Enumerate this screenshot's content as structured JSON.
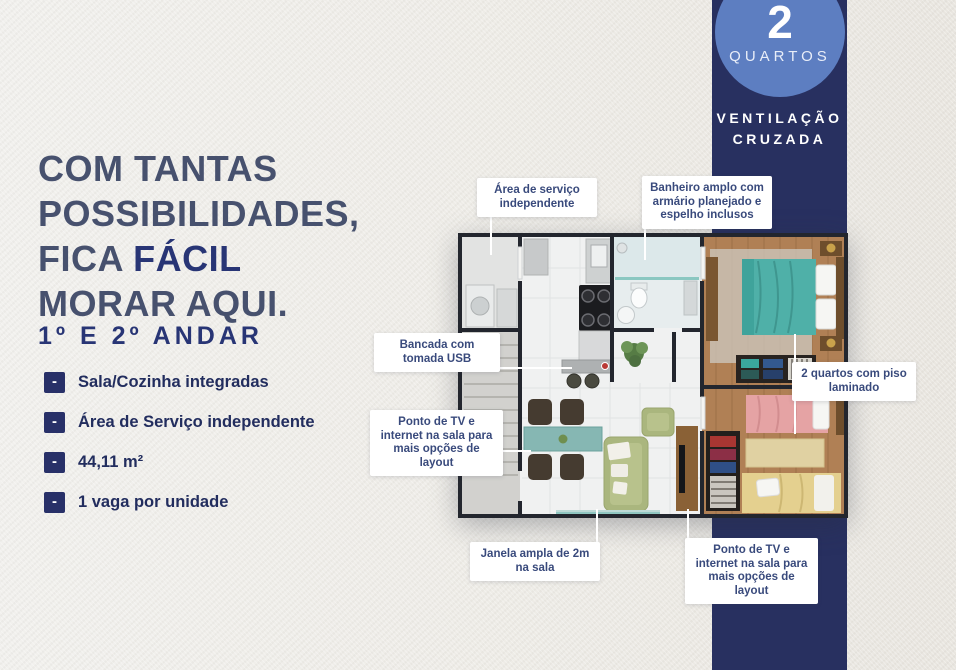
{
  "headline": {
    "line1": "COM TANTAS",
    "line2": "POSSIBILIDADES,",
    "line3_prefix": "FICA ",
    "line3_bold": "FÁCIL",
    "line4": "MORAR AQUI.",
    "subtitle": "1º E 2º ANDAR"
  },
  "features": {
    "bullet": "-",
    "items": [
      "Sala/Cozinha integradas",
      "Área de Serviço independente",
      "44,11 m²",
      "1 vaga por unidade"
    ]
  },
  "badge": {
    "number": "2",
    "label": "QUARTOS",
    "vent_line1": "VENTILAÇÃO",
    "vent_line2": "CRUZADA"
  },
  "callouts": {
    "area_servico": "Área de serviço independente",
    "banheiro": "Banheiro amplo com armário planejado e espelho inclusos",
    "bancada": "Bancada com tomada USB",
    "ponto_tv_sala": "Ponto de TV e internet na sala para mais opções de layout",
    "quartos_piso": "2 quartos com piso laminado",
    "janela": "Janela ampla de 2m na sala",
    "ponto_tv_sala_2": "Ponto de TV e internet na sala para mais opções de layout"
  },
  "colors": {
    "band_navy": "#283060",
    "badge_circle_blue": "#5d7ec1",
    "headline_light": "#47516e",
    "headline_bold": "#283575",
    "feature_text": "#222d5e",
    "callout_text": "#394a7c",
    "background": "#edebe6",
    "plan_wall": "#23262e",
    "plan_wood_floor": "#b08055",
    "plan_bed_teal": "#4fb0a8",
    "plan_bed_pink": "#e5a3a4",
    "plan_bed_yellow": "#e4d08f",
    "plan_sofa_green": "#aab67e",
    "plan_window_teal": "#8fc6c1"
  }
}
